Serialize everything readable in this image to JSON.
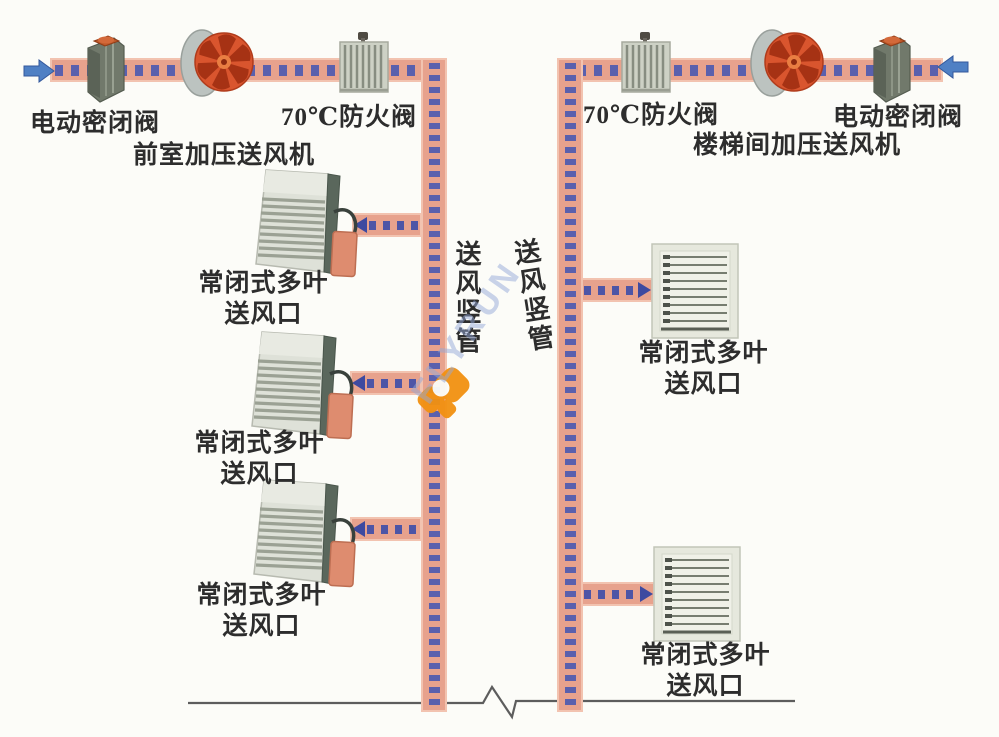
{
  "colors": {
    "duct_fill": "#e7a28d",
    "duct_dash_blue": "#5a60ad",
    "flow_arrow_blue": "#4f80c4",
    "fan_red": "#d9552e",
    "actuator_orange": "#de8c6f",
    "logo_orange": "#f29111",
    "label_text": "#2d2d2d",
    "ground_line": "#5d5d5d"
  },
  "icons": {
    "inlet_left": "block-arrow-right-icon",
    "inlet_right": "block-arrow-left-icon",
    "sealed_valve": "electric-sealed-valve-icon",
    "axial_fan": "axial-fan-icon",
    "fire_damper": "fire-damper-icon",
    "outlet_side_view": "louver-outlet-side-view-icon",
    "outlet_front_view": "louver-outlet-front-view-icon"
  },
  "left_system": {
    "valve_label": "电动密闭阀",
    "fire_damper_label": "70℃防火阀",
    "fan_label": "前室加压送风机",
    "riser_label": "送风竖管",
    "outlets": [
      {
        "line1": "常闭式多叶",
        "line2": "送风口"
      },
      {
        "line1": "常闭式多叶",
        "line2": "送风口"
      },
      {
        "line1": "常闭式多叶",
        "line2": "送风口"
      }
    ]
  },
  "right_system": {
    "fire_damper_label": "70℃防火阀",
    "valve_label": "电动密闭阀",
    "fan_label": "楼梯间加压送风机",
    "riser_label": "送风竖管",
    "outlets": [
      {
        "line1": "常闭式多叶",
        "line2": "送风口"
      },
      {
        "line1": "常闭式多叶",
        "line2": "送风口"
      }
    ]
  },
  "watermark": {
    "text": "FLYRUN"
  }
}
